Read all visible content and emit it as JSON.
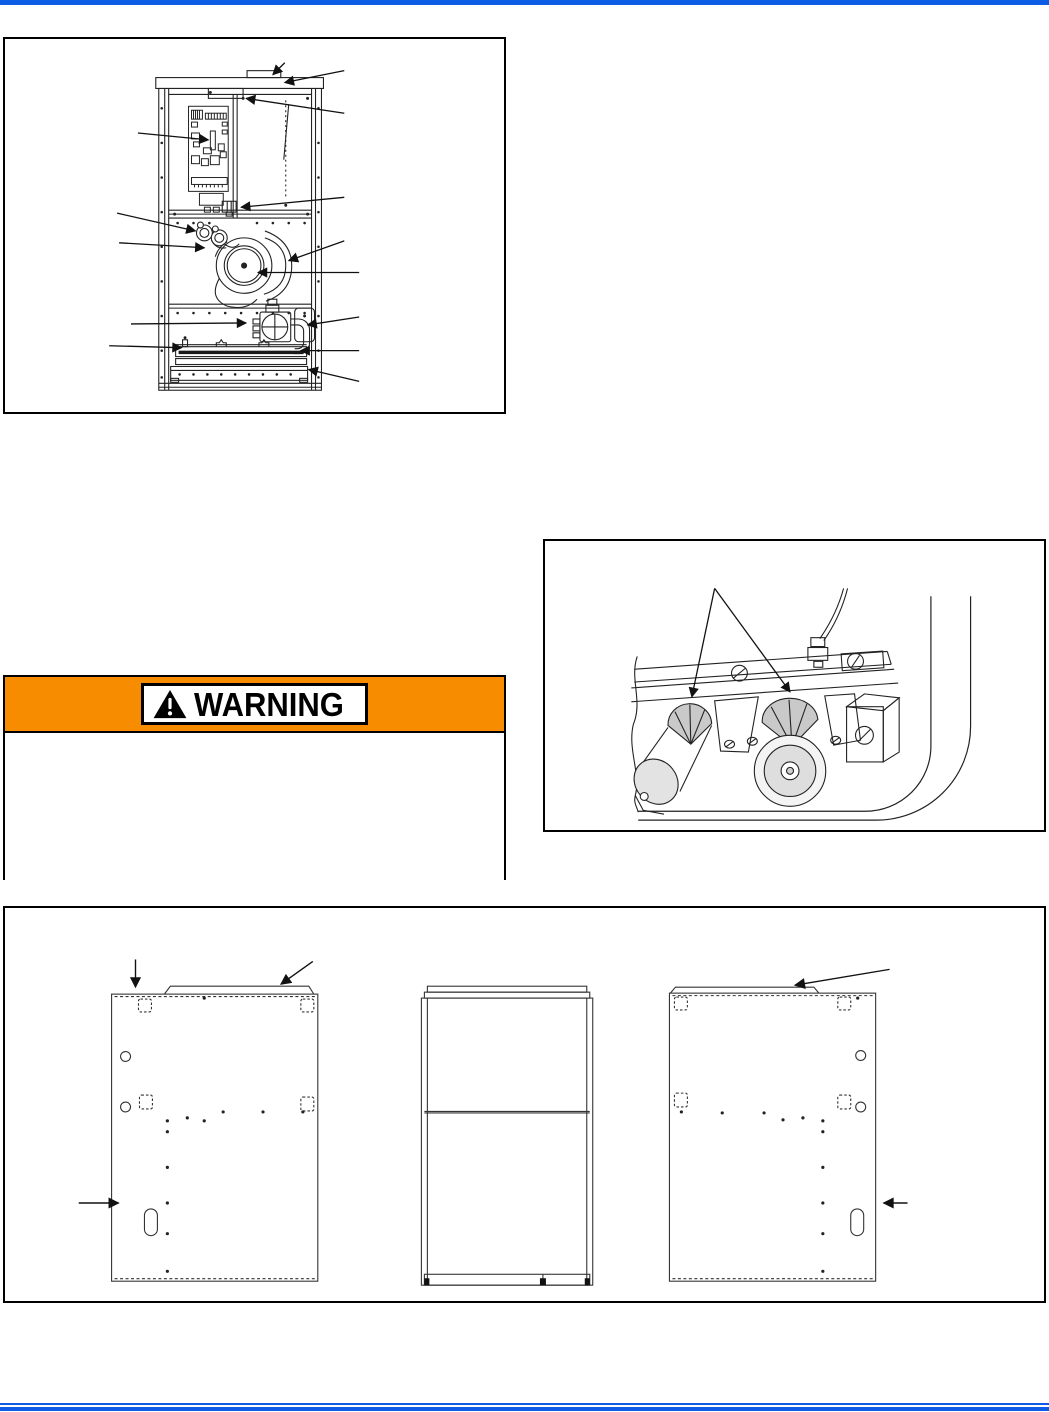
{
  "colors": {
    "accent_blue": "#0c5ce6",
    "warning_orange": "#f88c00",
    "line_dark": "#222222",
    "shade_gray": "#c9c9c9",
    "page_background": "#ffffff"
  },
  "header": {
    "top_rule_count": 1
  },
  "warning": {
    "label": "WARNING",
    "icon": "warning-triangle-icon",
    "body_text": ""
  },
  "figures": [
    {
      "id": "furnace-internal-components",
      "kind": "line-drawing-with-callout-arrows"
    },
    {
      "id": "burner-crossover-detail",
      "kind": "line-drawing-with-two-callout-arrows"
    },
    {
      "id": "cabinet-panel-views",
      "kind": "three-panel-line-drawing"
    }
  ],
  "footer": {
    "rule_count": 2
  }
}
